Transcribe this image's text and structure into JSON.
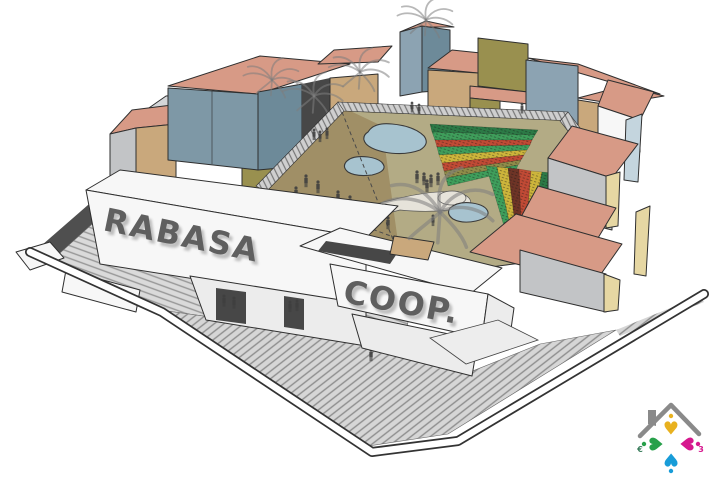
{
  "signage": {
    "rabasa": "RABASA",
    "coop": "COOP."
  },
  "logo": {
    "heart_glyph": "♥",
    "euro_symbol": "€",
    "three_symbol": "3",
    "colors": {
      "roof_gray": "#8a8a8a",
      "heart_yellow": "#e8b11f",
      "heart_green": "#27a04a",
      "heart_magenta": "#d6188e",
      "heart_blue": "#189cd8"
    }
  },
  "palette": {
    "roof_salmon": "#d79a86",
    "roof_salmon2": "#c98d77",
    "wall_teal": "#7e98a6",
    "wall_teal_dark": "#6d8a99",
    "wall_tan": "#c9a87c",
    "wall_olive": "#99904f",
    "wall_bluegray": "#8ca3b2",
    "wall_gray": "#c2c4c6",
    "wall_gray2": "#d4d6d8",
    "wall_white": "#f7f7f7",
    "wall_white2": "#ececec",
    "gable_yellow": "#e6d7a3",
    "wall_paleblue": "#c4d5de",
    "court_ground": "#b3ab85",
    "dirt": "#a08f66",
    "pond_blue": "#a7c3cf",
    "crop_green": "#3f9e5b",
    "crop_darkgreen": "#2c7a46",
    "crop_red": "#c14a35",
    "crop_yellow": "#cdb53b",
    "crop_maroon": "#6e3426",
    "crop_olive": "#8f8c49",
    "letter_gray": "#5f5f5f",
    "outline": "#2f2f2f",
    "dark_wall": "#4f4f4f",
    "passage_dark": "#474747",
    "path_light": "#e6e3da"
  }
}
